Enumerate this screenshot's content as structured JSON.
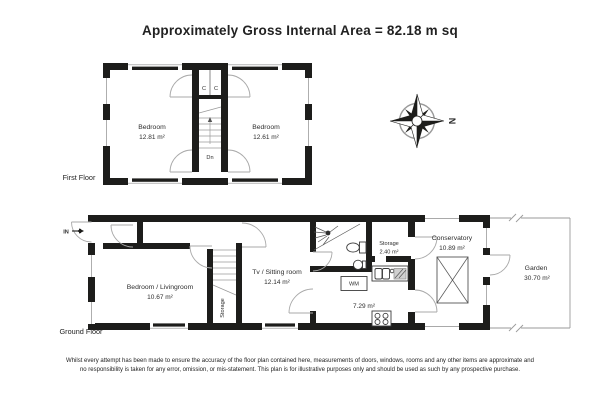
{
  "title": "Approximately Gross Internal Area = 82.18 m sq",
  "compass": {
    "north": "N"
  },
  "first_floor": {
    "label": "First Floor",
    "bedroom_left": {
      "name": "Bedroom",
      "area": "12.81 m²"
    },
    "bedroom_right": {
      "name": "Bedroom",
      "area": "12.61 m²"
    },
    "closet_left": "C",
    "closet_right": "C",
    "stairs_down": "Dn"
  },
  "ground_floor": {
    "label": "Ground Floor",
    "entrance": "IN",
    "bedroom_livingroom": {
      "name": "Bedroom / Livingroom",
      "area": "10.67 m²"
    },
    "tv_sitting_room": {
      "name": "Tv / Sitting room",
      "area": "12.14 m²"
    },
    "storage_room": {
      "name": "Storage",
      "area": "2.40 m²"
    },
    "understairs_storage": "Storage",
    "washing_machine": "WM",
    "kitchen": {
      "area": "7.29 m²"
    },
    "conservatory": {
      "name": "Conservatory",
      "area": "10.89 m²"
    },
    "garden": {
      "name": "Garden",
      "area": "30.70 m²"
    }
  },
  "disclaimer": {
    "line1": "Whilst every attempt has been made to ensure the accuracy of the floor plan contained here, measurements of doors, windows, rooms and any other items are approximate and",
    "line2": "no responsibility is taken for any error, omission, or mis-statement. This plan is for illustrative purposes only and should be used as such by any prospective purchase."
  },
  "colors": {
    "wall": "#1d1d1b",
    "detail_line": "#a9a9a9",
    "text": "#222222",
    "background": "#ffffff"
  }
}
